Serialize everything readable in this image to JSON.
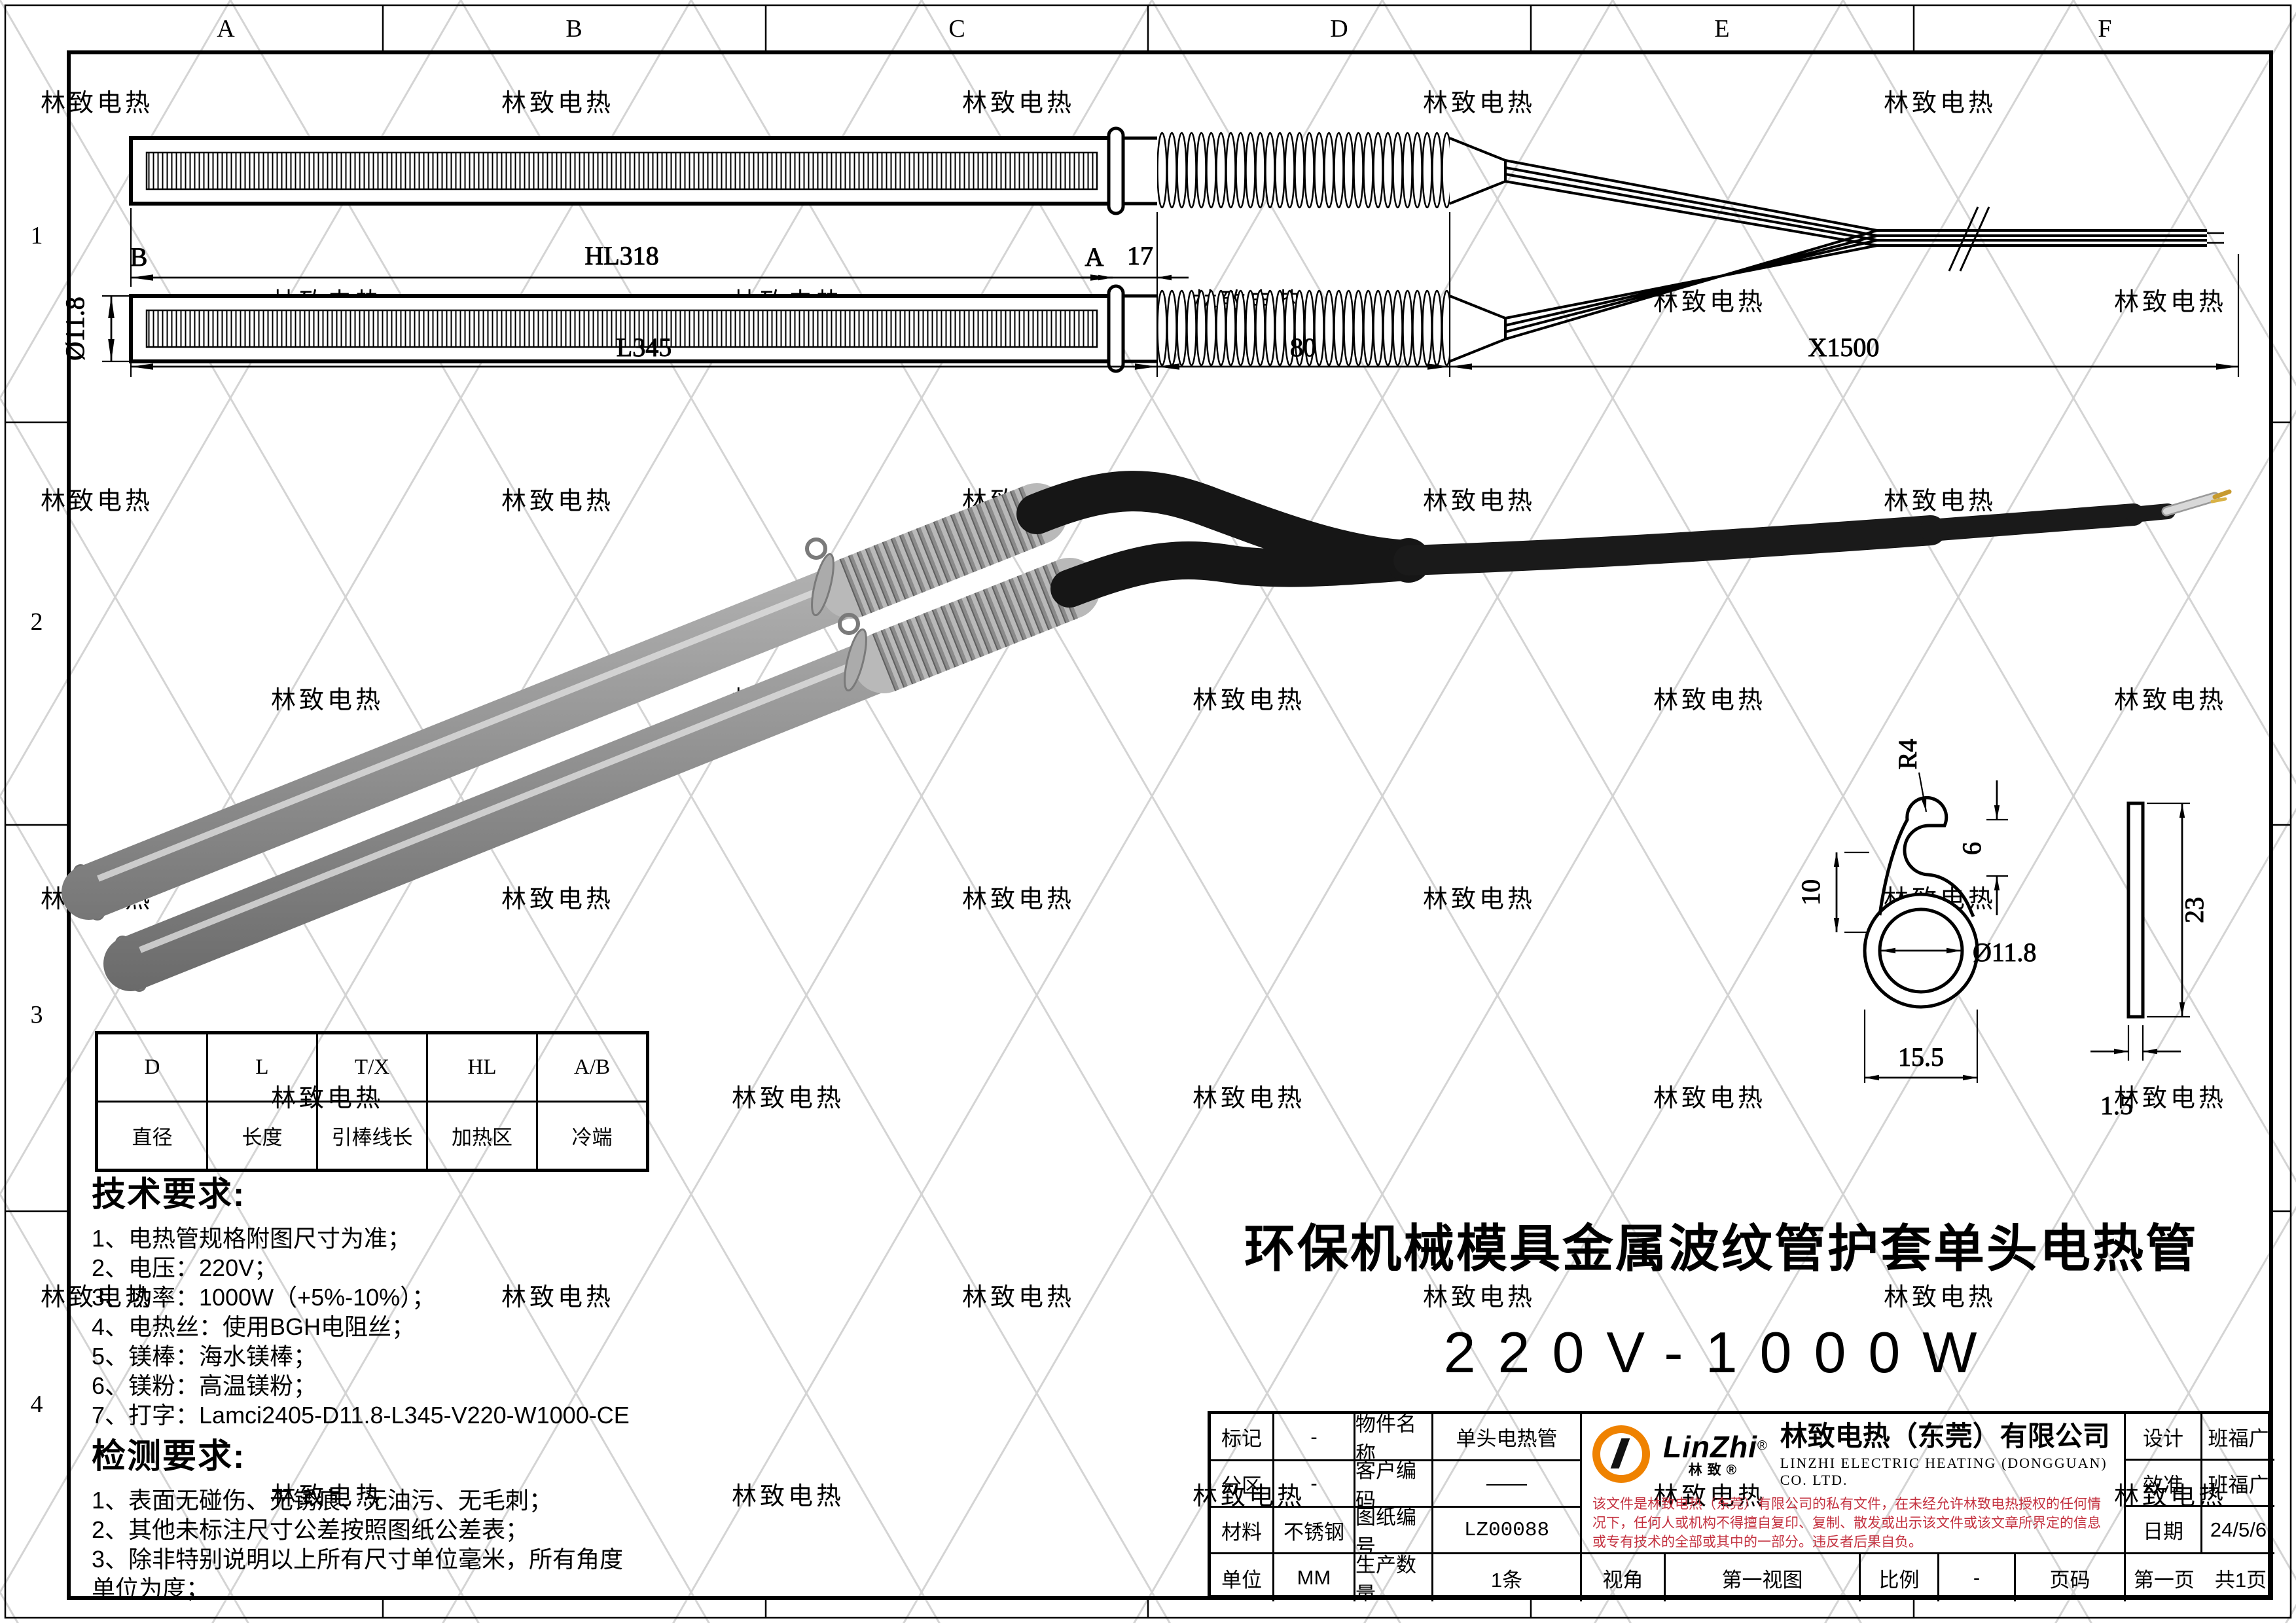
{
  "watermark": {
    "text": "林致电热"
  },
  "colors": {
    "brand_orange": "#ef8200",
    "disclaimer_red": "#c43240"
  },
  "border": {
    "columns": [
      "A",
      "B",
      "C",
      "D",
      "E",
      "F"
    ],
    "rows": [
      "1",
      "2",
      "3",
      "4"
    ]
  },
  "top_view": {
    "labels": {
      "b": "B",
      "a": "A",
      "hl": "HL318",
      "seg17": "17",
      "dia": "Ø11.8",
      "l": "L345",
      "seg80": "80",
      "x": "X1500"
    }
  },
  "detail": {
    "r4": "R4",
    "h10": "10",
    "h6": "6",
    "dia": "Ø11.8",
    "w": "15.5",
    "h": "23",
    "t": "1.5"
  },
  "param_table": {
    "headers": [
      "D",
      "L",
      "T/X",
      "HL",
      "A/B"
    ],
    "values": [
      "直径",
      "长度",
      "引棒线长",
      "加热区",
      "冷端"
    ]
  },
  "tech": {
    "heading": "技术要求:",
    "items": [
      "1、电热管规格附图尺寸为准；",
      "2、电压：220V；",
      "3、功率：1000W（+5%-10%）；",
      "4、电热丝：使用BGH电阻丝；",
      "5、镁棒：海水镁棒；",
      "6、镁粉：高温镁粉；",
      "7、打字：Lamci2405-D11.8-L345-V220-W1000-CE"
    ]
  },
  "inspect": {
    "heading": "检测要求:",
    "items": [
      "1、表面无碰伤、无锈痕、无油污、无毛刺；",
      "2、其他未标注尺寸公差按照图纸公差表；",
      "3、除非特别说明以上所有尺寸单位毫米，所有角度单位为度；"
    ]
  },
  "product": {
    "title": "环保机械模具金属波纹管护套单头电热管",
    "spec": "220V-1000W"
  },
  "title_block": {
    "mark_label": "标记",
    "mark_value": "-",
    "part_label": "物件名称",
    "part_value": "单头电热管",
    "zone_label": "分区",
    "zone_value": "-",
    "customer_label": "客户编码",
    "customer_value": "——",
    "material_label": "材料",
    "material_value": "不锈钢",
    "drawing_no_label": "图纸编号",
    "drawing_no_value": "LZ00088",
    "unit_label": "单位",
    "unit_value": "MM",
    "qty_label": "生产数量",
    "qty_value": "1条",
    "view_label": "视角",
    "view_value": "第一视图",
    "scale_label": "比例",
    "scale_value": "-",
    "page_label": "页码",
    "page_value": "第一页　共1页",
    "design_label": "设计",
    "design_value": "班福广",
    "check_label": "效准",
    "check_value": "班福广",
    "date_label": "日期",
    "date_value": "24/5/6"
  },
  "company": {
    "logo_text": "LinZhi",
    "logo_reg": "®",
    "logo_sub": "林致®",
    "name": "林致电热（东莞）有限公司",
    "name_en": "LINZHI ELECTRIC HEATING (DONGGUAN) CO. LTD.",
    "disclaimer": "该文件是林致电热（东莞）有限公司的私有文件，在未经允许林致电热授权的任何情况下，任何人或机构不得擅自复印、复制、散发或出示该文件或该文章所界定的信息或专有技术的全部或其中的一部分。违反者后果自负。"
  }
}
